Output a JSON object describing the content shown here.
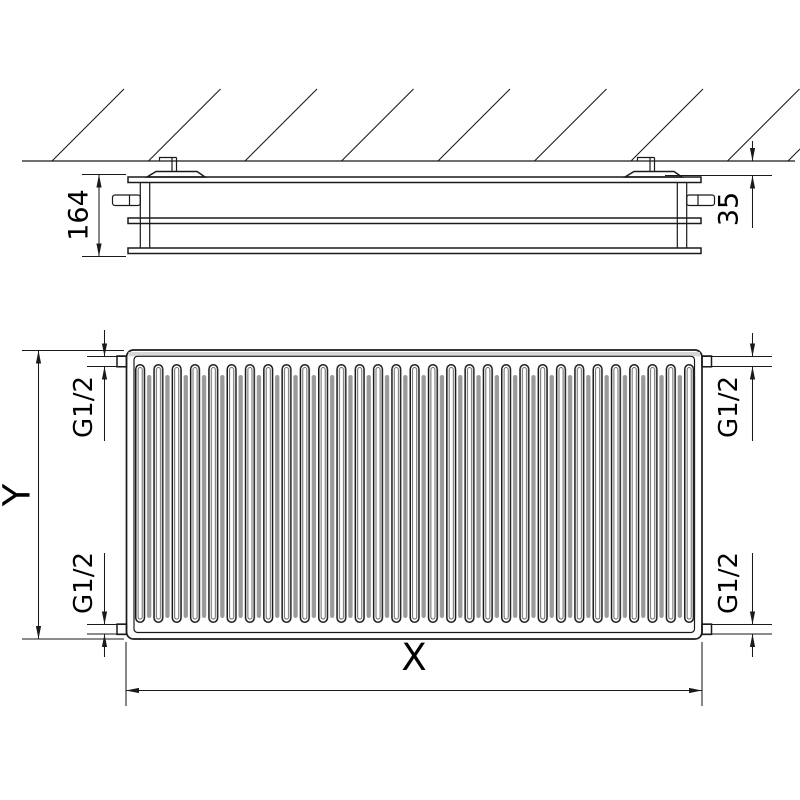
{
  "drawing": {
    "kind": "panel radiator technical drawing, side view with wall mounting (top) and front view (bottom)",
    "labels": {
      "radiator_depth_mm": "164",
      "wall_distance_mm": "35",
      "width_dim": "X",
      "height_dim": "Y",
      "connection_top_left": "G1/2",
      "connection_top_right": "G1/2",
      "connection_bottom_left": "G1/2",
      "connection_bottom_right": "G1/2"
    },
    "colors": {
      "line": "#1a1a1a",
      "background": "#ffffff",
      "panel_fill": "#e8e8e8",
      "top_edge_band": "#d6d6d6",
      "fin_shadow": "#9a9a9a"
    }
  }
}
